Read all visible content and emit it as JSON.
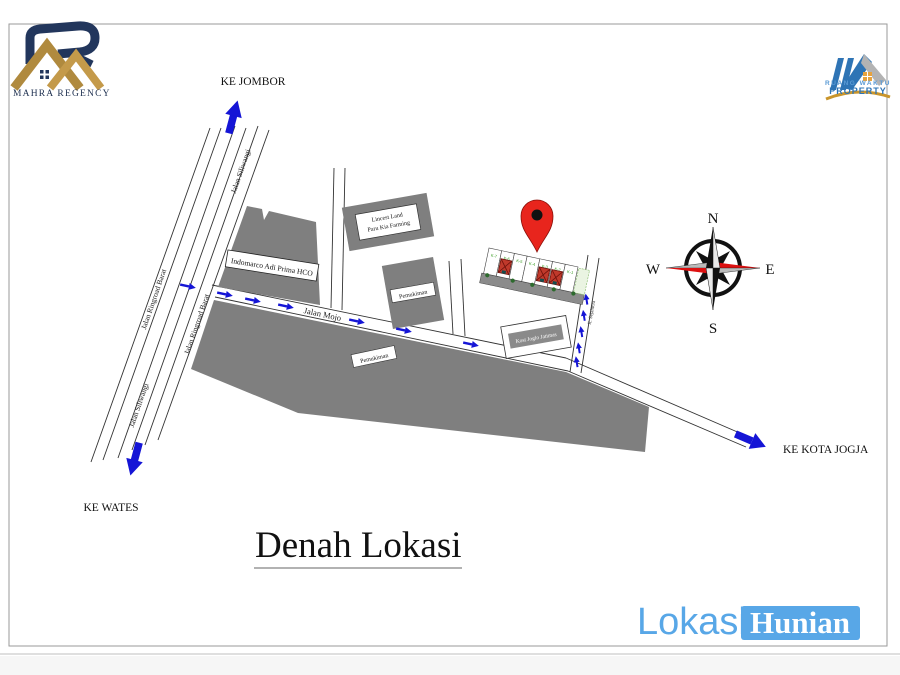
{
  "branding": {
    "mahra_regency": {
      "name": "MAHRA REGENCY"
    },
    "ruang_waktu": {
      "line1": "RUANG WAKTU",
      "line2": "PROPERTY"
    }
  },
  "title": "Denah Lokasi",
  "footer": {
    "lokasi": "Lokasi",
    "hunian": "Hunian"
  },
  "directions": {
    "north": "KE JOMBOR",
    "south": "KE WATES",
    "east": "KE KOTA JOGJA"
  },
  "roads": {
    "siliwangi_upper": "Jalan Siliwangi",
    "ringroad_left": "Jalan Ringroad Barat",
    "ringroad_right": "Jalan Ringroad Barat",
    "siliwangi_lower": "Jalan Siliwangi",
    "mojo": "Jalan Mojo",
    "sejahtera": "Jl. Sejahtera"
  },
  "buildings": {
    "indomarco": "Indomarco Adi Prima HCO",
    "lincest_line1": "Lincest Land",
    "lincest_line2": "Paru Kia Farming",
    "pemukiman_upper": "Pemukiman",
    "pemukiman_lower": "Pemukiman",
    "kost": "Kost Joglo Jatimas"
  },
  "site_plan": {
    "lots": [
      "K-7",
      "K-6",
      "K-5",
      "K-4",
      "K-3",
      "K-2",
      "K-1"
    ]
  },
  "compass": {
    "n": "N",
    "e": "E",
    "s": "S",
    "w": "W"
  },
  "colors": {
    "arrow_blue": "#1515d6",
    "building_gray": "#7f7f7f",
    "pin_red": "#e8251d",
    "brand_gold": "#b08a3e",
    "brand_navy": "#22365c",
    "footer_blue": "#58a7e7",
    "lot_label_green": "#3a9d23"
  }
}
